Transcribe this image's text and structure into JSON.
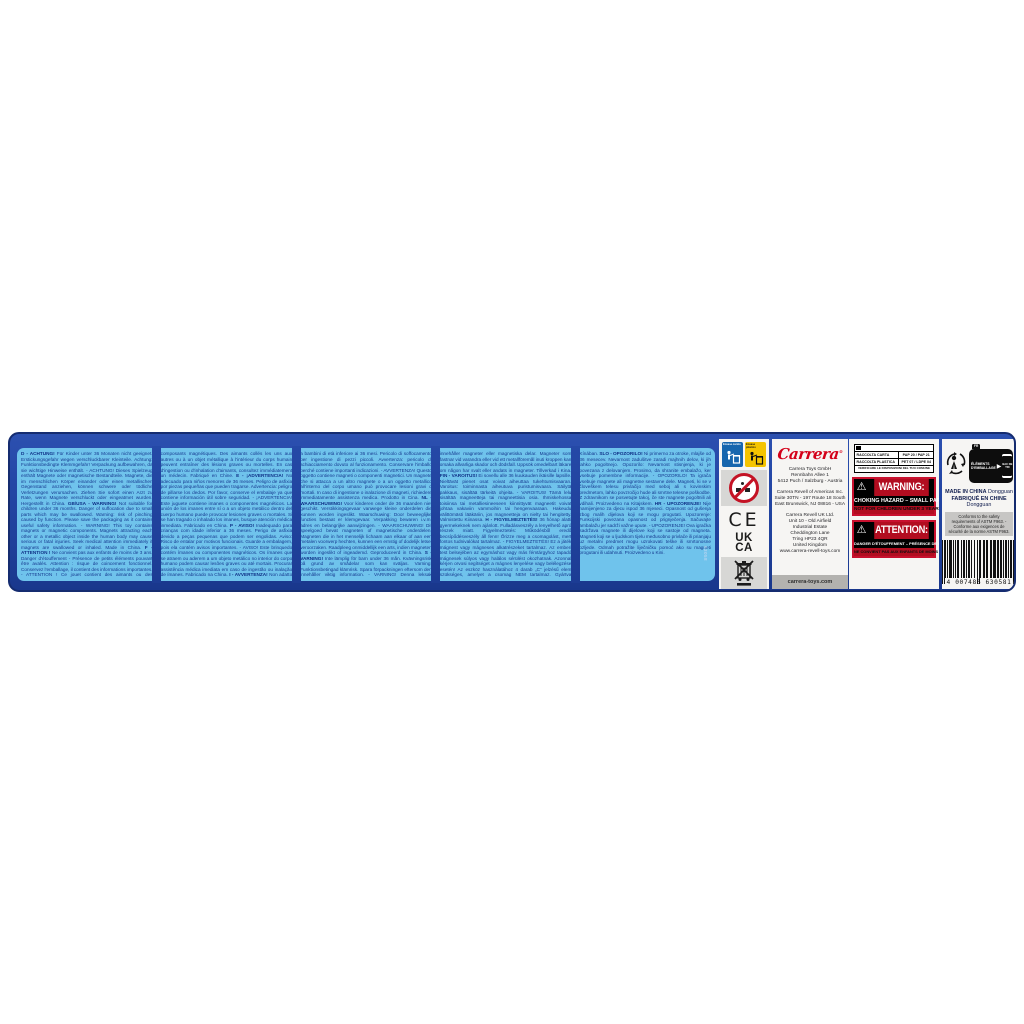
{
  "colors": {
    "panel_blue": "#2245a3",
    "text_box_blue": "#6fc3ec",
    "warning_text_blue": "#16398f",
    "brand_red": "#d40019",
    "hazard_red": "#b20d20",
    "sorting_blue": "#1766ae",
    "sorting_yellow": "#f5c400"
  },
  "warnings": {
    "languages": [
      {
        "code": "D",
        "head": "ACHTUNG!",
        "body": "Für Kinder unter 36 Monaten nicht geeignet. Erstickungsgefahr wegen verschluckbarer Kleinteile. Achtung: Funktionsbedingte Klemmgefahr! Verpackung aufbewahren, da sie wichtige Hinweise enthält. - ACHTUNG! Dieses Spielzeug enthält Magnete oder magnetische Bestandteile. Magnete, die im menschlichen Körper einander oder einen metallischen Gegenstand anziehen, können schwere oder tödliche Verletzungen verursachen. Ziehen Sie sofort einen Arzt zu Rate, wenn Magnete verschluckt oder eingeatmet wurden. Hergestellt in China."
      },
      {
        "code": "GB/USA",
        "head": "WARNING!",
        "body": "Not suitable for children under 36 months. Danger of suffocation due to small parts which may be swallowed. Warning: risk of pinching caused by function. Please save the packaging as it contains useful safety information. - WARNING! This toy contains magnets or magnetic components. Magnets attracting each other or a metallic object inside the human body may cause serious or fatal injuries. Seek medical attention immediately if magnets are swallowed or inhaled. Made in China."
      },
      {
        "code": "F",
        "head": "ATTENTION !",
        "body": "Ne convient pas aux enfants de moins de 3 ans. Danger d'étouffement - Présence de petits éléments pouvant être avalés. Attention : risque de coincement fonctionnel. Conservez l'emballage, il contient des informations importantes. - ATTENTION ! Ce jouet contient des aimants ou des composants magnétiques. Des aimants collés les uns aux autres ou à un objet métallique à l'intérieur du corps humain peuvent entraîner des lésions graves ou mortelles. En cas d'ingestion ou d'inhalation d'aimants, consultez immédiatement un médecin. Fabriqué en Chine."
      },
      {
        "code": "E",
        "head": "¡ADVERTENCIA!",
        "body": "No adecuado para niños menores de 36 meses. Peligro de asfixia por piezas pequeñas que pueden tragarse. Advertencia: peligro de pillarse los dedos. Por favor, conserve el embalaje ya que contiene información útil sobre seguridad. - ¡ADVERTENCIA! Este juguete contiene imanes o componentes magnéticos. La unión de los imanes entre sí o a un objeto metálico dentro del cuerpo humano puede provocar lesiones graves o mortales. Si se han tragado o inhalado los imanes, busque atención médica inmediata. Fabricado en China."
      },
      {
        "code": "P",
        "head": "AVISO!",
        "body": "Inadequado para crianças com idade inferior a 36 meses. Perigo de asfixia devido a peças pequenas que podem ser engolidas. Aviso: Risco de entalar por motivos funcionais. Guarde a embalagem, pois ela contém avisos importantes. - AVISO! Este brinquedo contém ímanes ou componentes magnéticos. Os ímanes que se atraem ou aderem a um objeto metálico no interior do corpo humano podem causar lesões graves ou até mortais. Procurar assistência médica imediata em caso de ingestão ou inalação de ímanes. Fabricado na China."
      },
      {
        "code": "I",
        "head": "AVVERTENZA!",
        "body": "Non adatto a bambini di età inferiore ai 36 mesi. Pericolo di soffocamento per ingestione di pezzi piccoli. Avvertenza: pericolo di schiacciamento dovuto al funzionamento. Conservare l'imballo perché contiene importanti indicazioni. - AVVERTENZA! Questo oggetto contiene magneti o componenti magnetici. Un magnete che si attacca a un altro magnete o a un oggetto metallico all'interno del corpo umano può provocare lesioni gravi o mortali. In caso di ingestione o inalazione di magneti, richiedere immediatamente assistenza medica. Prodotto in Cina."
      },
      {
        "code": "NL",
        "head": "WAARSCHUWING!",
        "body": "Voor kinderen onder de 36 maanden niet geschikt. Verstikkingsgevaar vanwege kleine onderdelen die kunnen worden ingeslikt. Waarschuwing: Door beweeglijke functies bestaat er klemgevaar. Verpakking bewaren i.v.m. adres en belangrijke aanwijzingen. - WAARSCHUWING! Dit speelgoed bevat magneten of magnetische onderdelen. Magneten die in het menselijk lichaam aan elkaar of aan een metalen voorwerp hechten, kunnen een ernstig of dodelijk letsel veroorzaken. Raadpleeg onmiddellijk een arts, indien magneten worden ingeslikt of ingeademd. Geproduceerd in China."
      },
      {
        "code": "S",
        "head": "VARNING!",
        "body": "Inte lämplig för barn under 36 mån. Kvävningsrisk på grund av smådelar som kan sväljas. Varning: Funktionsbetingad klämrisk. Spara förpackningen eftersom den innehåller viktig information. - VARNING! Denna leksak innehåller magneter eller magnetiska delar. Magneter som fastnar vid varandra eller vid ett metallföremål inuti kroppen kan orsaka allvarliga skador och dödsfall. Uppsök omedelbart läkare om någon har svalt eller andats in magneter. Tillverkad i Kina."
      },
      {
        "code": "FIN",
        "head": "VAROITUS!",
        "body": "Ei sovellu alle 36 kuukauden ikäisille lapsille. Nieltävät pienet osat voivat aiheuttaa tukehtumisvaaran. Varoitus: toiminnasta aiheutuva puristumisvaara. Säilytä pakkaus, sisältää tärkeitä ohjeita. - VAROITUS! Tämä lelu sisältää magneetteja tai magneettisia osia. Ihmiskehossa toisiinsa tai metalliesineeseen kiinnittyvät magneetit voivat johtaa vakaviin vammoihin tai hengenvaaraan. Hakeudu välittömästi lääkäriin, jos magneetteja on nielty tai hengitetty. Valmistettu Kiinassa."
      },
      {
        "code": "H",
        "head": "FIGYELMEZTETÉS!",
        "body": "36 hónap alatti gyermekeknek nem ajánlott. Fulladásveszély a lenyelhető apró részek miatt. Figyelmeztetés: Működésből eredő becsípődésveszély áll fenn! Őrizze meg a csomagolást, mert fontos tudnivalókat tartalmaz. - FIGYELMEZTETÉS! Ez a játék mágnest vagy mágneses alkatrészeket tartalmaz. Az emberi test belsejében az egymáshoz vagy más fémtárgyhoz tapadó mágnesek súlyos vagy halálos sérülést okozhatnak. Azonnal kérjen orvosi segítséget a mágnes lenyelése vagy belélegzése esetén! Az eszköz használatához 4 darab „C” jelzésű elem szükséges, amelyet a csomag NEM tartalmaz. Gyártva Kínában."
      },
      {
        "code": "SLO",
        "head": "OPOZORILO!",
        "body": "Ni primerno za otroke, mlajše od 36 mesecev. Nevarnost zadušitve zaradi majhnih delov, ki jih lahko pogoltnejo. Opozorilo: Nevarnost stisnjenja, ki je povezana z delovanjem. Prosimo, da shranite embalažo, ker vsebuje pomembne informacije. - OPOZORILO! Ta igrača vsebuje magnete ali magnetne sestavne dele. Magneti, ki se v človeškem telesu privlačijo med seboj ali s kovinskim predmetom, lahko povzročijo hude ali smrtne telesne poškodbe. Z zdravnikom se posvetujte takoj, če ste magnete pogoltnili ali vdihali. Proizvedeno na Kitajskem."
      },
      {
        "code": "HR",
        "head": "UPOZORENJE!",
        "body": "Nije namijenjeno za djecu ispod 36 mjeseci. Opasnost od gušenja zbog malih dijelova koji se mogu progutati. Upozorenje: Funkcijski povezana opasnost od prignječenja. Sačuvajte ambalažu jer sadrži važne upute. - UPOZORENJE! Ova igračka sadržava magnete ili dijelove koji se sastoje od magneta. Magneti koji se u ljudskom tijelu međusobno privlače ili prianjaju uz metalni predmet mogu uzrokovati teške ili smrtonosne ozljede. Odmah potražite liječničku pomoć ako su magneti progutani ili udahnuti. Proizvedeno u Kini."
      }
    ]
  },
  "vertical_code": "63058",
  "sorting_icons": {
    "blue_label": "Envase cartón",
    "yellow_label": "Envase plástico"
  },
  "marks": {
    "ce": "CE",
    "ukca_line1": "UK",
    "ukca_line2": "CA"
  },
  "brand": {
    "logo": "Carrera",
    "registered": "®",
    "website_bar": "carrera-toys.com"
  },
  "addresses": {
    "austria": "Carrera Toys GmbH\nRennbahn Allee 1\n5412 Puch / Salzburg - Austria",
    "usa": "Carrera Revell of Americas Inc.\nSuite 30TN - 197 Route 18 South\nEast Brunswick, NJ 08816 - USA",
    "uk": "Carrera Revell UK Ltd.\nUnit 10 - Old Airfield\nIndustrial Estate\nCheddington Lane\nTring HP23 4QR\nUnited Kingdom\nwww.carrera-revell-toys.com"
  },
  "disposal_table": {
    "rows": [
      {
        "left": "RACCOLTA CARTA",
        "right": "PAP 20 / PAP 21"
      },
      {
        "left": "RACCOLTA PLASTICA",
        "right": "PET 07 / LDPE 04"
      }
    ],
    "footer": "VERIFICARE LE DISPOSIZIONI DEL TUO COMUNE"
  },
  "hazard_labels": {
    "warning": {
      "icon": "⚠",
      "word": "WARNING:",
      "line2": "CHOKING HAZARD – SMALL PARTS",
      "line3": "NOT FOR CHILDREN UNDER 3 YEARS."
    },
    "attention": {
      "icon": "⚠",
      "word": "ATTENTION:",
      "line2": "DANGER D'ÉTOUFFEMENT – PRÉSENCE DE PETITES PIÈCES",
      "line3": "NE CONVIENT PAS AUX ENFANTS DE MOINS DE 3 ANS."
    }
  },
  "triman": {
    "region": "FR",
    "text": "ÉLÉMENTS D'EMBALLAGE",
    "bin_text": "BAC DE TRI"
  },
  "origin": {
    "line1_bold": "MADE IN CHINA",
    "line1_normal": " Dongguan",
    "line2_bold": "FABRIQUÉ EN CHINE",
    "line2_normal": " Dongguan",
    "astm": "Conforms to the safety requirements of ASTM F963. - Conforme aux exigences de sécurité de la norme ASTM F963."
  },
  "barcode": {
    "value": "4007486630581",
    "display": "4 007486 630581"
  }
}
